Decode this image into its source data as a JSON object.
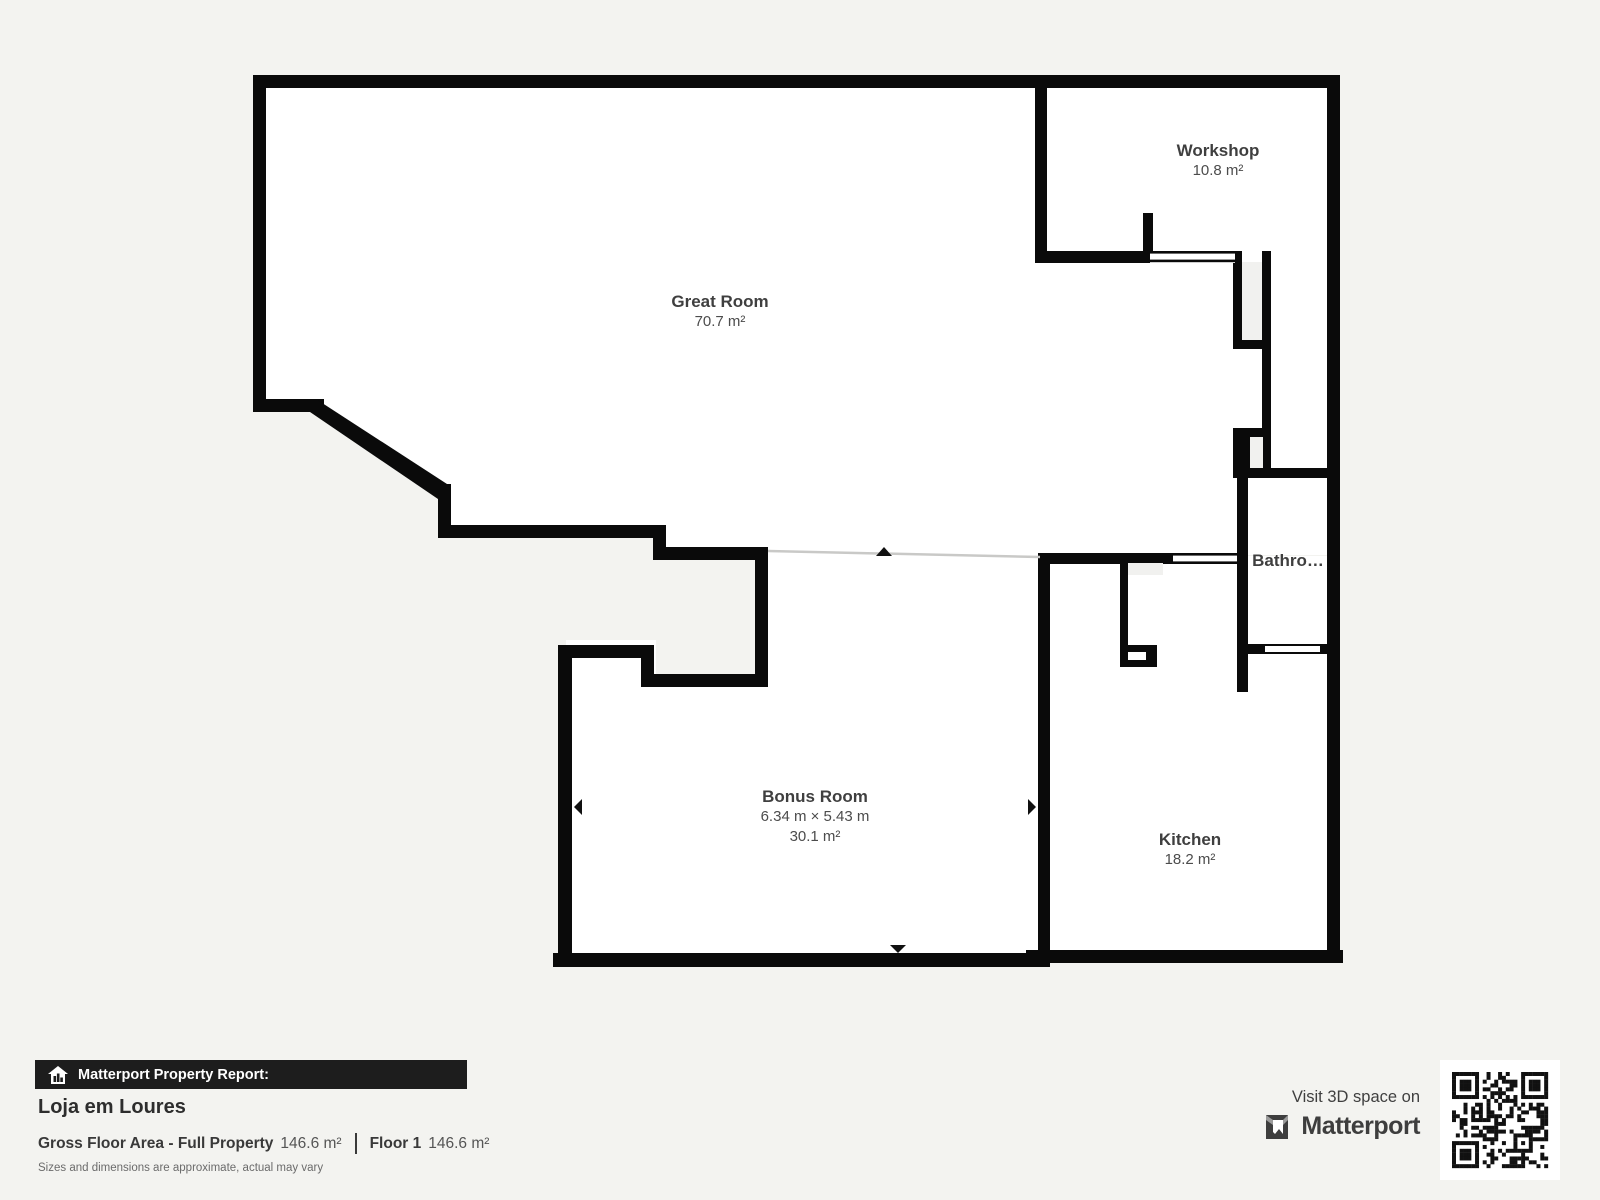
{
  "plan": {
    "rooms": {
      "great_room": {
        "name": "Great Room",
        "area": "70.7 m²"
      },
      "workshop": {
        "name": "Workshop",
        "area": "10.8 m²"
      },
      "bathroom": {
        "name": "Bathro…"
      },
      "bonus_room": {
        "name": "Bonus Room",
        "dimensions": "6.34 m × 5.43 m",
        "area": "30.1 m²"
      },
      "kitchen": {
        "name": "Kitchen",
        "area": "18.2 m²"
      }
    }
  },
  "report": {
    "bar_label": "Matterport Property Report:",
    "property_name": "Loja em Loures",
    "gross_floor_area_label": "Gross Floor Area - Full Property",
    "gross_floor_area_value": "146.6 m²",
    "floor_label": "Floor 1",
    "floor_value": "146.6 m²",
    "disclaimer": "Sizes and dimensions are approximate, actual may vary"
  },
  "promo": {
    "visit_text": "Visit 3D space on",
    "brand": "Matterport"
  },
  "colors": {
    "wall": "#0a0a0a",
    "floor": "#ffffff",
    "background": "#f3f3f0",
    "shaft": "#f1f1ef",
    "label_text": "#3f3f3f",
    "bar_background": "#1d1d1d",
    "bar_text": "#ffffff"
  }
}
